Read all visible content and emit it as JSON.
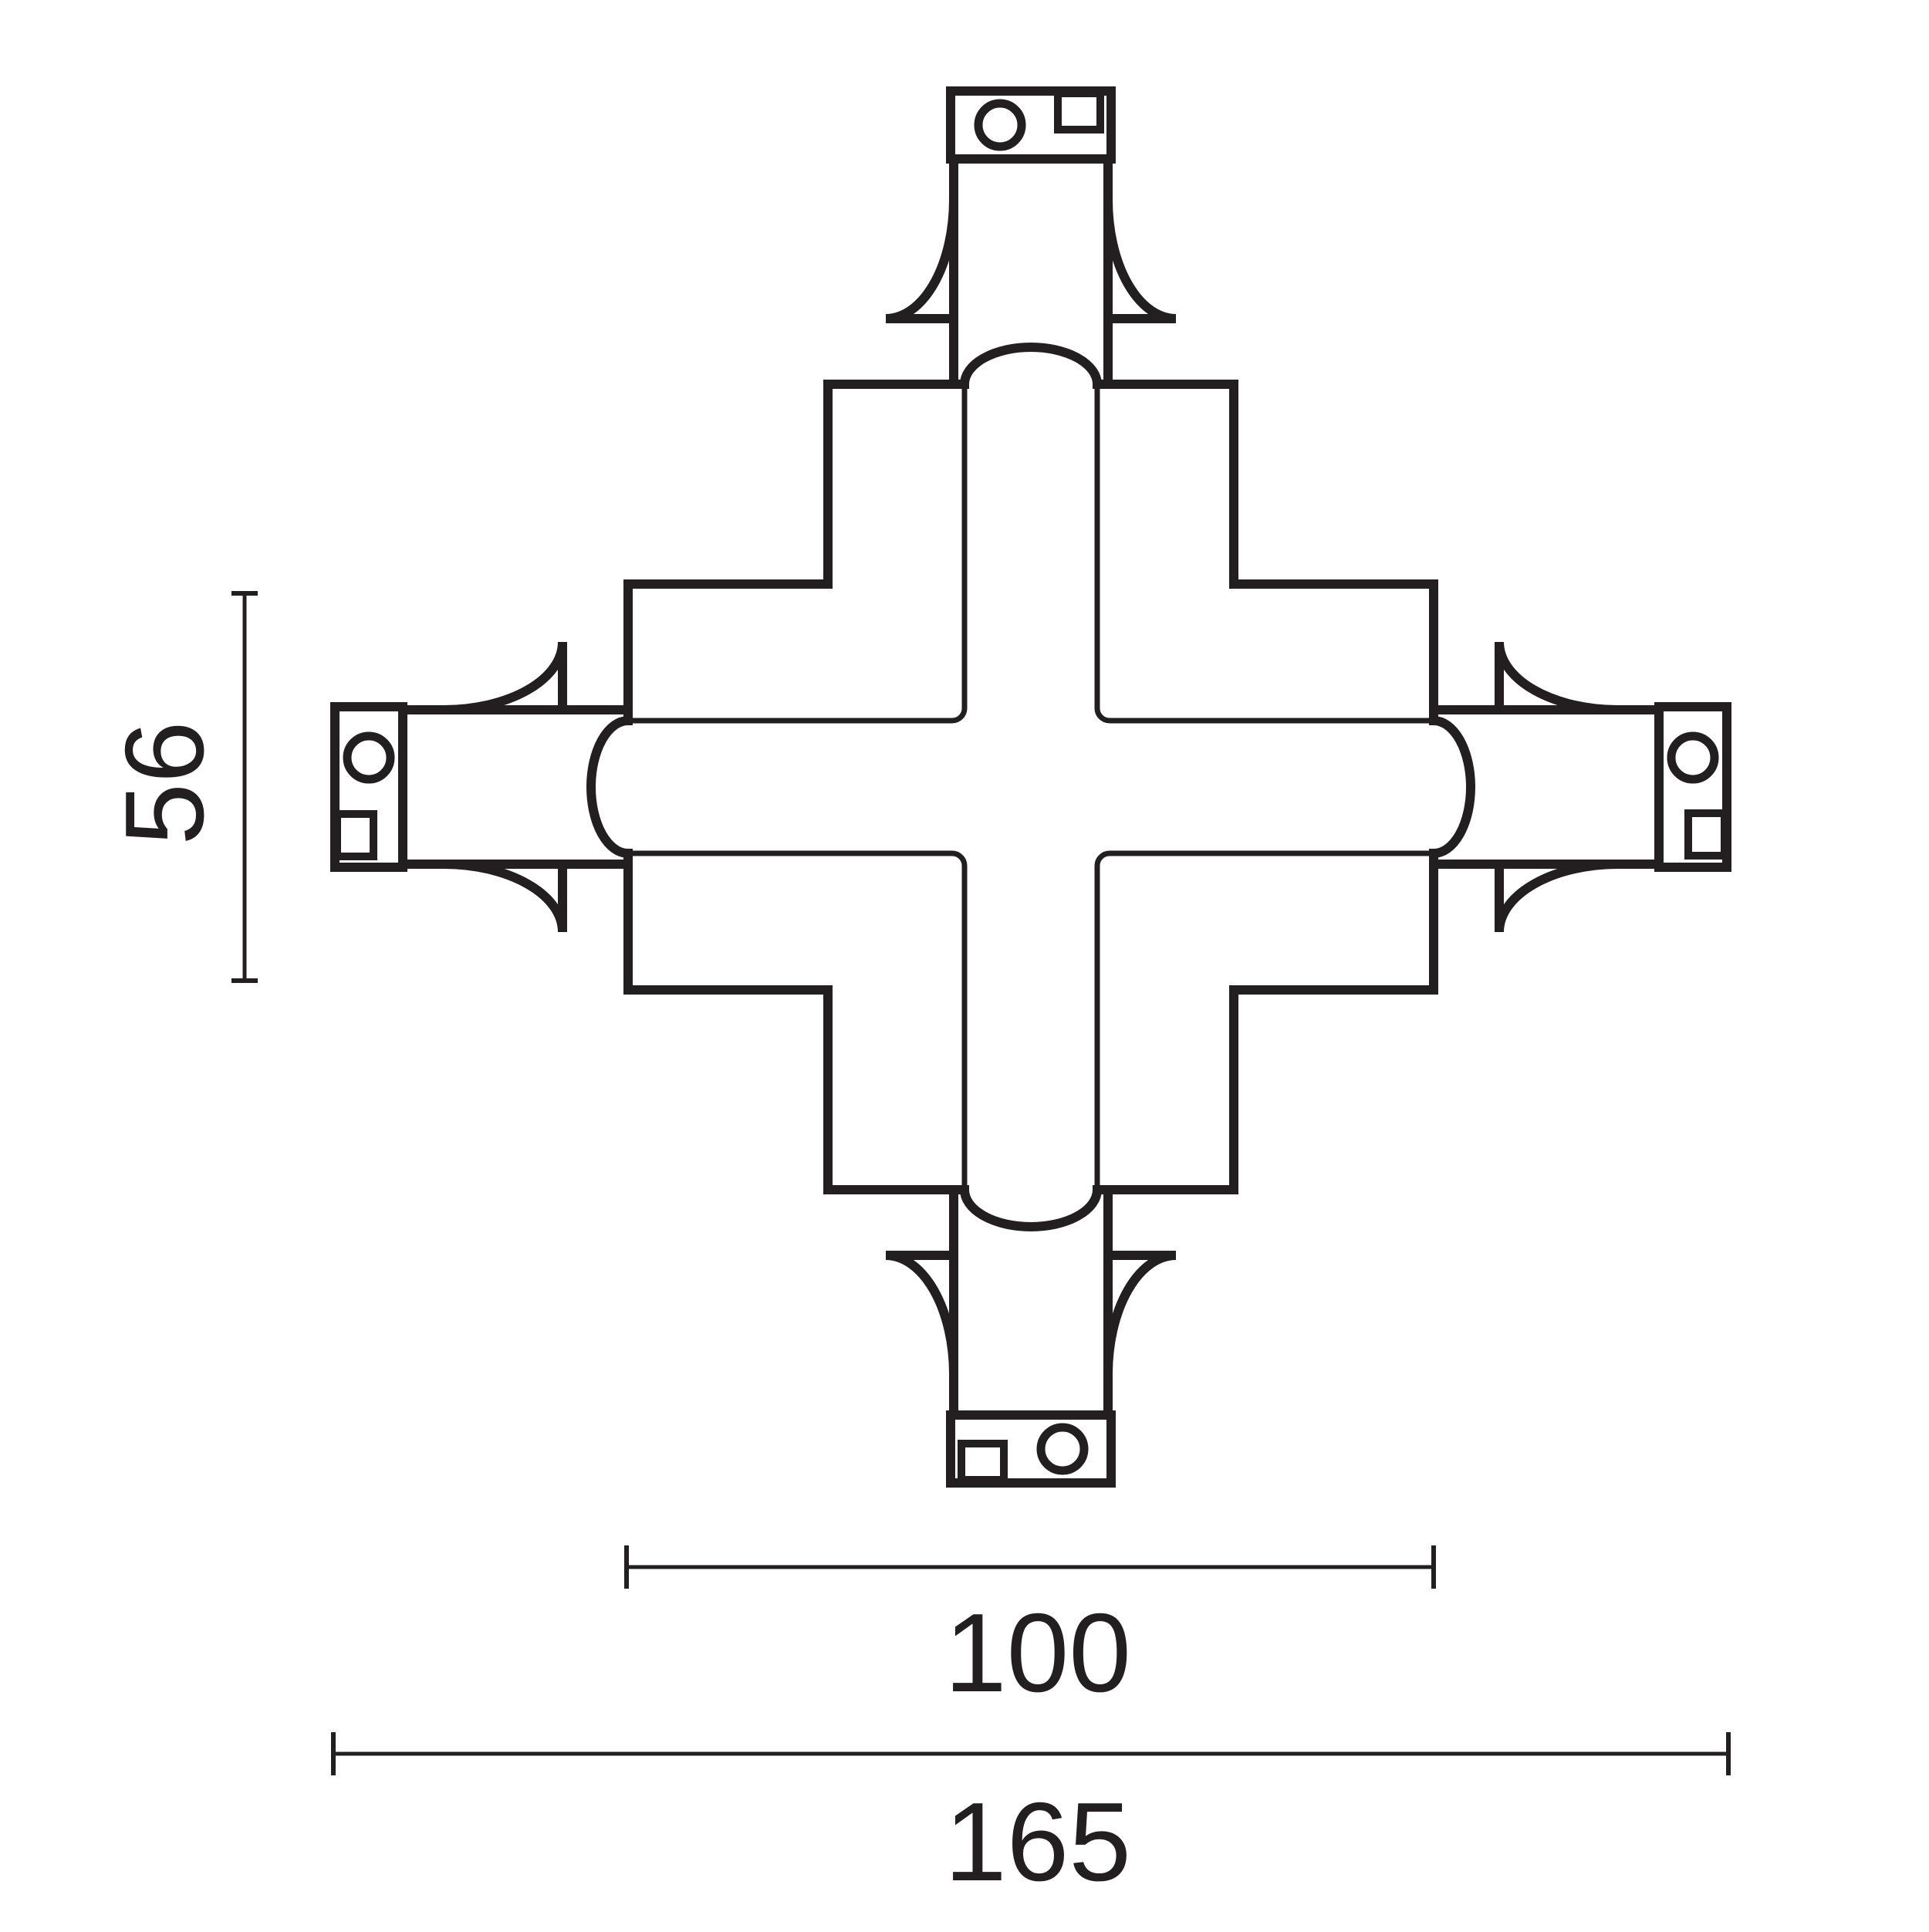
{
  "colors": {
    "ink": "#231f20",
    "background": "#ffffff"
  },
  "drawing": {
    "type": "technical-plan-line-drawing",
    "subject": "cross-shaped track connector, top view",
    "components": [
      "stepped-cross-body",
      "end-cap",
      "cap-contact-circle",
      "cap-contact-square",
      "quarter-round-tab",
      "inner-track-channel"
    ]
  },
  "dimensions": {
    "side_height": {
      "label": "56",
      "orientation": "vertical"
    },
    "inner_width": {
      "label": "100",
      "orientation": "horizontal"
    },
    "overall_width": {
      "label": "165",
      "orientation": "horizontal"
    }
  }
}
